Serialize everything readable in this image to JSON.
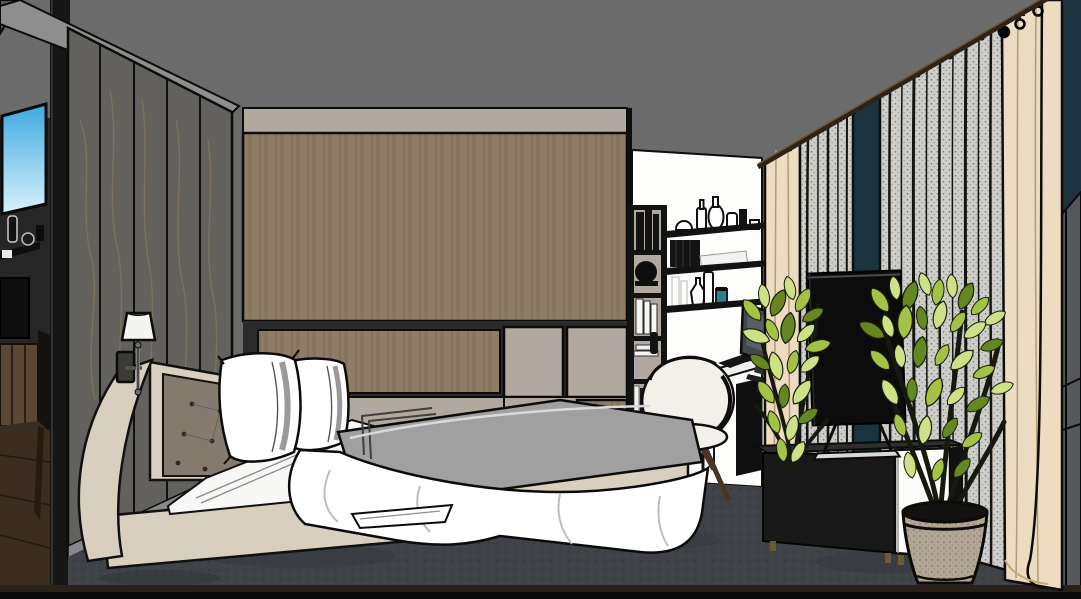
{
  "scene": {
    "type": "3d-interior-render",
    "room": "bedroom-with-study-corner",
    "objects": [
      "ceiling",
      "adjacent-room-glimpse",
      "door-jamb",
      "marble-accent-wall",
      "wall-sconce",
      "wood-feature-wall",
      "taupe-cabinet-panels",
      "bed",
      "tufted-headboard",
      "pillows",
      "white-duvet",
      "bed-sheet",
      "open-bookshelf",
      "floating-wall-shelves",
      "decor-vases",
      "desk",
      "desktop-monitor",
      "desk-drawer-unit",
      "white-shell-chair",
      "television",
      "media-console",
      "potted-plant-left",
      "potted-plant-right",
      "planter-pot",
      "gray-curtains",
      "cream-curtains",
      "curtain-rod",
      "windows",
      "carpet-floor"
    ]
  },
  "colors": {
    "ceiling": "#6b6b6b",
    "ceiling_corner": "#575757",
    "soffit": "#8e8e8e",
    "jamb": "#161616",
    "marble": "#62615d",
    "marble_vein": "#93805f",
    "baseboard": "#87878b",
    "wall_taupe": "#b1a99f",
    "wood": "#8d7b64",
    "wood_shadow": "#2b2b2b",
    "white_wall": "#fdfdfc",
    "window_sky_top": "#3fa8e0",
    "window_sky_bottom": "#d9f2fc",
    "window_night": "#1c3440",
    "curtain_gray": "#cdcdc9",
    "curtain_speck": "#77776f",
    "curtain_cream": "#eddcc2",
    "curtain_rod": "#2c2218",
    "corner_wall": "#54575c",
    "floor_carpet": "#3f4246",
    "floor_wood": "#3a2c1f",
    "floor_strip": "#2a2118",
    "bottom_bar": "#0a0a0a",
    "bed_cream": "#d9cfbf",
    "headboard_tufted": "#847b6e",
    "pillow_white": "#ffffff",
    "pillow_shade": "#bcbcbc",
    "sheet_white": "#f7f7f6",
    "duvet_gray": "#a0a0a0",
    "shelf_black": "#121212",
    "books_dark": "#141414",
    "chair_white": "#f3f0ea",
    "chair_leg": "#4a3524",
    "desk_top": "#f0f0ee",
    "desk_taupe": "#a79f94",
    "drawer_black": "#101010",
    "monitor_gray": "#42474c",
    "tv_black": "#0c0c0c",
    "console_black": "#181818",
    "console_door": "#fcfcfb",
    "leaf": "#a4c243",
    "leaf_light": "#cfe187",
    "leaf_dark": "#64871f",
    "stem": "#161a0e",
    "pot": "#b2a795",
    "soil": "#141210",
    "glass_teal": "#2a7f8a",
    "cabinet_wood": "#5b4733",
    "interior_dark": "#262626",
    "sconce_shade": "#f4f4f2"
  }
}
